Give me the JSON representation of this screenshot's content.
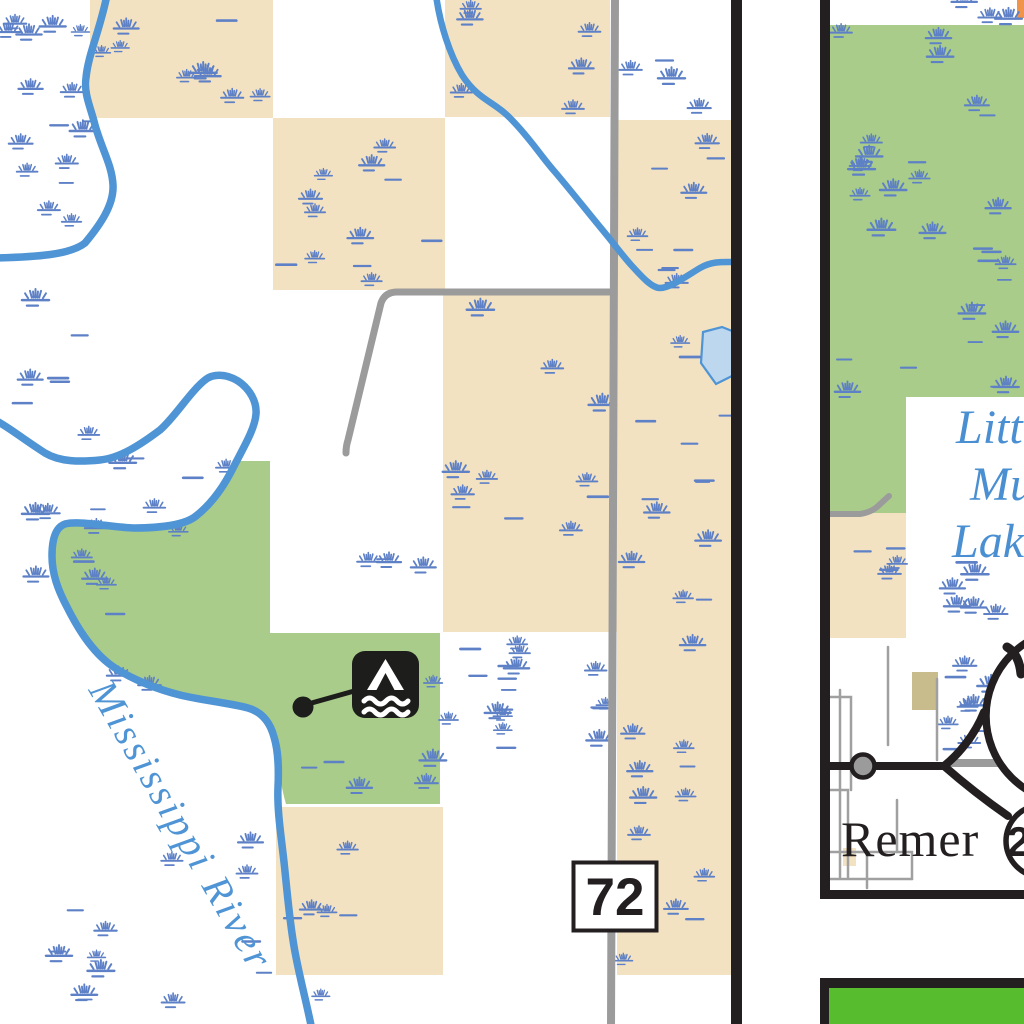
{
  "map_type": "recreation-atlas-map",
  "panel_main": {
    "river_label": "Mississippi River",
    "highway_shield": "72",
    "campsite_icon": "campsite-water-access-icon"
  },
  "panel_right": {
    "town_label": "Remer",
    "lake_label": {
      "line1": "Little",
      "line2": "Mud",
      "line3": "Lake"
    },
    "shield_small": "200",
    "shield_large": "6"
  },
  "colors": {
    "section_tan": "#f3e2c2",
    "public_land_green": "#a9cc8a",
    "legend_bright_green": "#57bd2f",
    "river_blue": "#4f94d4",
    "marsh_blue": "#5d80c6",
    "lake_fill": "#bcd7ee",
    "road_gray": "#9b9b9b",
    "map_black": "#231f20",
    "khaki_block": "#c9bc8c",
    "orange_sliver": "#ef9449",
    "water_label_blue": "#4a8fd2"
  }
}
